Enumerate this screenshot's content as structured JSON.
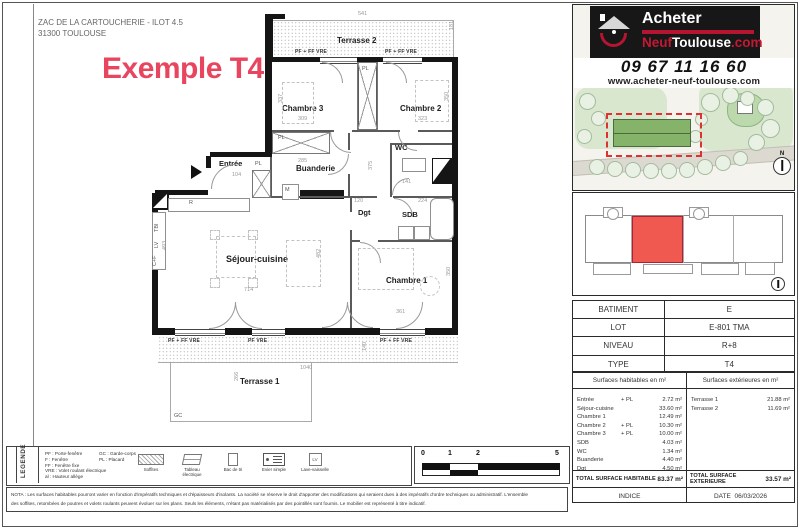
{
  "header": {
    "address1": "ZAC DE LA CARTOUCHERIE - ILOT 4.5",
    "address2": "31300 TOULOUSE",
    "watermark": "Exemple T4"
  },
  "branding": {
    "acheter": "Acheter",
    "neuf": "Neuf",
    "toulouse": "Toulouse",
    "com": ".com",
    "phone": "09 67 11 16 60",
    "website": "www.acheter-neuf-toulouse.com",
    "colors": {
      "logo_red": "#b51531",
      "accent_pink": "#e8455f",
      "unit_red": "#f0594f"
    }
  },
  "site": {
    "north": "N"
  },
  "info_table": {
    "rows": [
      {
        "label": "BATIMENT",
        "value": "E"
      },
      {
        "label": "LOT",
        "value": "E-801 TMA"
      },
      {
        "label": "NIVEAU",
        "value": "R+8"
      },
      {
        "label": "TYPE",
        "value": "T4"
      }
    ]
  },
  "surfaces": {
    "hab_header": "Surfaces habitables en m²",
    "ext_header": "Surfaces extérieures en m²",
    "habitables": [
      {
        "name": "Entrée",
        "plus": "+ PL",
        "value": "2.72 m²"
      },
      {
        "name": "Séjour-cuisine",
        "plus": "",
        "value": "33.60 m²"
      },
      {
        "name": "Chambre 1",
        "plus": "",
        "value": "12.49 m²"
      },
      {
        "name": "Chambre 2",
        "plus": "+ PL",
        "value": "10.30 m²"
      },
      {
        "name": "Chambre 3",
        "plus": "+ PL",
        "value": "10.00 m²"
      },
      {
        "name": "SDB",
        "plus": "",
        "value": "4.03 m²"
      },
      {
        "name": "WC",
        "plus": "",
        "value": "1.34 m²"
      },
      {
        "name": "Buanderie",
        "plus": "",
        "value": "4.40 m²"
      },
      {
        "name": "Dgt",
        "plus": "",
        "value": "4.50 m²"
      }
    ],
    "exterieures": [
      {
        "name": "Terrasse 1",
        "value": "21.88 m²"
      },
      {
        "name": "Terrasse 2",
        "value": "11.69 m²"
      }
    ],
    "total_hab_label": "TOTAL SURFACE HABITABLE",
    "total_hab_value": "83.37 m²",
    "total_ext_label": "TOTAL SURFACE EXTERIEURE",
    "total_ext_value": "33.57 m²",
    "indice_label": "INDICE",
    "date_label": "DATE",
    "date_value": "06/03/2026"
  },
  "plan": {
    "rooms": [
      "Terrasse 2",
      "Chambre 3",
      "Chambre 2",
      "Buanderie",
      "Entrée",
      "WC",
      "Dgt",
      "SDB",
      "Séjour-cuisine",
      "Chambre 1",
      "Terrasse 1"
    ],
    "window_labels": [
      "PF + FF  VRE",
      "PF + FF  VRE",
      "PF + FF  VRE",
      "PF VRE",
      "PF + FF  VRE"
    ],
    "dimensions": [
      "541",
      "181",
      "337",
      "309",
      "323",
      "350",
      "285",
      "104",
      "375",
      "141",
      "120",
      "224",
      "493",
      "714",
      "482",
      "361",
      "350",
      "1040",
      "266",
      "140"
    ],
    "misc": [
      "PL",
      "PL",
      "PL",
      "M",
      "R",
      "TBI",
      "LV",
      "C+F",
      "GC"
    ]
  },
  "legend": {
    "title": "LEGENDE",
    "abbr_col1": [
      "PF : Porte-fenêtre",
      "F : Fenêtre",
      "FF : Fenêtre fixe",
      "VRE : Volet roulant électrique",
      "al : Hauteur allège"
    ],
    "abbr_col2": [
      "GC : Garde-corps",
      "PL : Placard"
    ],
    "icons": [
      {
        "caption": "Soffites",
        "glyph": ""
      },
      {
        "caption": "Tableau électrique",
        "glyph": ""
      },
      {
        "caption": "Bac de tri",
        "glyph": ""
      },
      {
        "caption": "Evier simple",
        "glyph": ""
      },
      {
        "caption": "Lave-vaisselle",
        "glyph": "LV"
      }
    ]
  },
  "scalebar": {
    "ticks": [
      "0",
      "1",
      "2",
      "5"
    ]
  },
  "nota": {
    "line1": "NOTA : Les surfaces habitables pourront varier en fonction d'impératifs techniques et d'épaisseurs d'isolants. La société se réserve le droit d'apporter des modifications qui seraient dues à des impératifs d'ordre techniques ou administratif. L'ensemble",
    "line2": "des soffites, retombées de poutres et volets roulants peuvent évoluer sur les plans. Seuls les éléments, n'étant pas matérialisés par des pointillés sont fournis. Le mobilier est représenté à titre indicatif."
  }
}
